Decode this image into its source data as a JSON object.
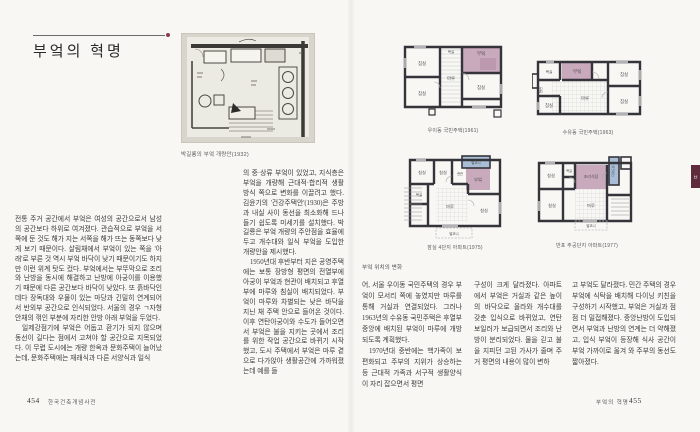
{
  "colors": {
    "accent": "#8c3a52",
    "kitchen_pink": "#c9a9bc",
    "balcony_blue": "#a9bed6",
    "wall": "#34343a"
  },
  "index_tab": {
    "label": "ㅂ"
  },
  "left_page": {
    "title": "부엌의 혁명",
    "sketch_caption": "박길룡의 부엌 개량안(1932)",
    "col1_p1": "전통 주거 공간에서 부엌은 여성의 공간으로서 남성의 공간보다 하위로 여겨졌다. 관습적으로 부엌을 서쪽에 둔 것도 해가 지는 서쪽을 해가 뜨는 동쪽보다 낮게 보기 때문이다. 살림채에서 부엌이 있는 쪽을 '아래'로 부른 것 역시 부엌 바닥이 낮기 때문이기도 하지만 이런 위계 탓도 컸다. 부엌에서는 부뚜막으로 조리와 난방을 동시에 해결하고 난방에 아궁이를 이용했기 때문에 다른 공간보다 바닥이 낮았다. 또 흙바닥인 데다 장독대와 우물이 있는 마당과 긴밀히 연계되어서 반외부 공간으로 인식되었다. 서울의 경우 ㄱ자형 안채의 꺾인 부분에 자리한 안방 아래 부엌을 두었다.",
    "col1_p2": "일제강점기에 부엌은 어둡고 환기가 되지 않으며 동선이 길다는 점에서 고쳐야 할 공간으로 지목되었다. 이 무렵 도시에는 개량 한옥과 문화주택이 늘어났는데, 문화주택에는 재래식과 다른 서양식과 일식",
    "col2_p1": "의 중·상류 부엌이 있었고, 지식층은 부엌을 개량해 근대적·합리적 생활 방식 쪽으로 변화를 이끌려고 했다. 김윤기의 '건강주택안'(1930)은 주방과 내실 사이 동선을 최소화해 드나들기 쉽도록 미세기를 설치했다. 박길룡은 부엌 개량의 주안점을 효율에 두고 개수대와 일식 부엌을 도입한 개량안을 제시했다.",
    "col2_p2": "1950년대 후반부터 지은 공영주택에는 보통 장방형 평면의 전열부에 아궁이 부엌과 현관이 배치되고 후열부에 마루와 침실이 배치되었다. 부엌이 마루와 차별되는 낮은 바닥을 지닌 채 주택 안으로 들어온 것이다. 이후 연탄아궁이와 수도가 들어오면서 부엌은 불을 지키는 곳에서 조리를 위한 작업 공간으로 바뀌기 시작했고, 도시 주택에서 부엌은 마루 곁으로 다가앉아 생활공간에 가까워졌는데 예를 들",
    "footer_page": "454",
    "footer_book": "한국건축개념사전"
  },
  "right_page": {
    "group_caption": "부엌 위치의 변화",
    "plans": {
      "p1": {
        "caption": "우이동 국민주택(1961)",
        "rooms": {
          "kitchen": "부엌",
          "maru": "마루",
          "bed1": "침실",
          "bed2": "침실",
          "bed3": "침실",
          "bath": "욕실"
        }
      },
      "p2": {
        "caption": "수유동 국민주택(1963)",
        "rooms": {
          "kitchen": "부엌",
          "maru": "마루",
          "bed1": "침실",
          "bed2": "침실",
          "bed3": "침실",
          "bath": "욕실",
          "entry": "현관"
        }
      },
      "p3": {
        "caption": "잠실 4단지 아파트(1975)",
        "rooms": {
          "balcony_top": "발코니",
          "kitchen": "부엌",
          "entry": "현관",
          "bed1": "침실",
          "bed2": "침실",
          "bath": "욕실",
          "maru": "마루",
          "bed3": "침실",
          "balcony_bottom": "발코니"
        }
      },
      "p4": {
        "caption": "반포 주공단지 아파트(1977)",
        "rooms": {
          "dk": "조리식당",
          "utility": "다용도실",
          "bed1": "침실",
          "bath": "욕실",
          "bed2": "침실",
          "maru": "마루",
          "balcony": "발코니"
        }
      }
    },
    "col1_p1": "어, 서울 우이동 국민주택의 경우 부엌이 모서리 쪽에 놓였지만 마루를 통해 거실과 연결되었다. 그러나 1963년의 수유동 국민주택은 후열부 중앙에 배치된 부엌이 마루에 개방되도록 계획했다.",
    "col1_p2": "1970년대 중반에는 핵가족이 보편화되고 주부의 지위가 상승하는 등 근대적 가족과 서구적 생활양식이 자리 잡으면서 평면",
    "col2": "구성이 크게 달라졌다. 아파트에서 부엌은 거실과 같은 높이의 바닥으로 올라와 개수대를 갖춘 입식으로 바뀌었고, 연탄보일러가 보급되면서 조리와 난방이 분리되었다. 물을 긷고 불을 지피던 고된 가사가 줄며 주거 평면의 내용이 많이 변하",
    "col3": "고 부엌도 달라졌다. 민간 주택의 경우 부엌에 식탁을 배치해 다이닝 키친을 구성하기 시작했고, 부엌은 거실과 점점 더 밀접해졌다. 중앙난방이 도입되면서 부엌과 난방의 연계는 더 약해졌고, 입식 부엌이 등장해 식사 공간이 부엌 가까이로 옮겨 와 주부의 동선도 짧아졌다.",
    "footer_title": "부엌의 혁명",
    "footer_page": "455"
  }
}
